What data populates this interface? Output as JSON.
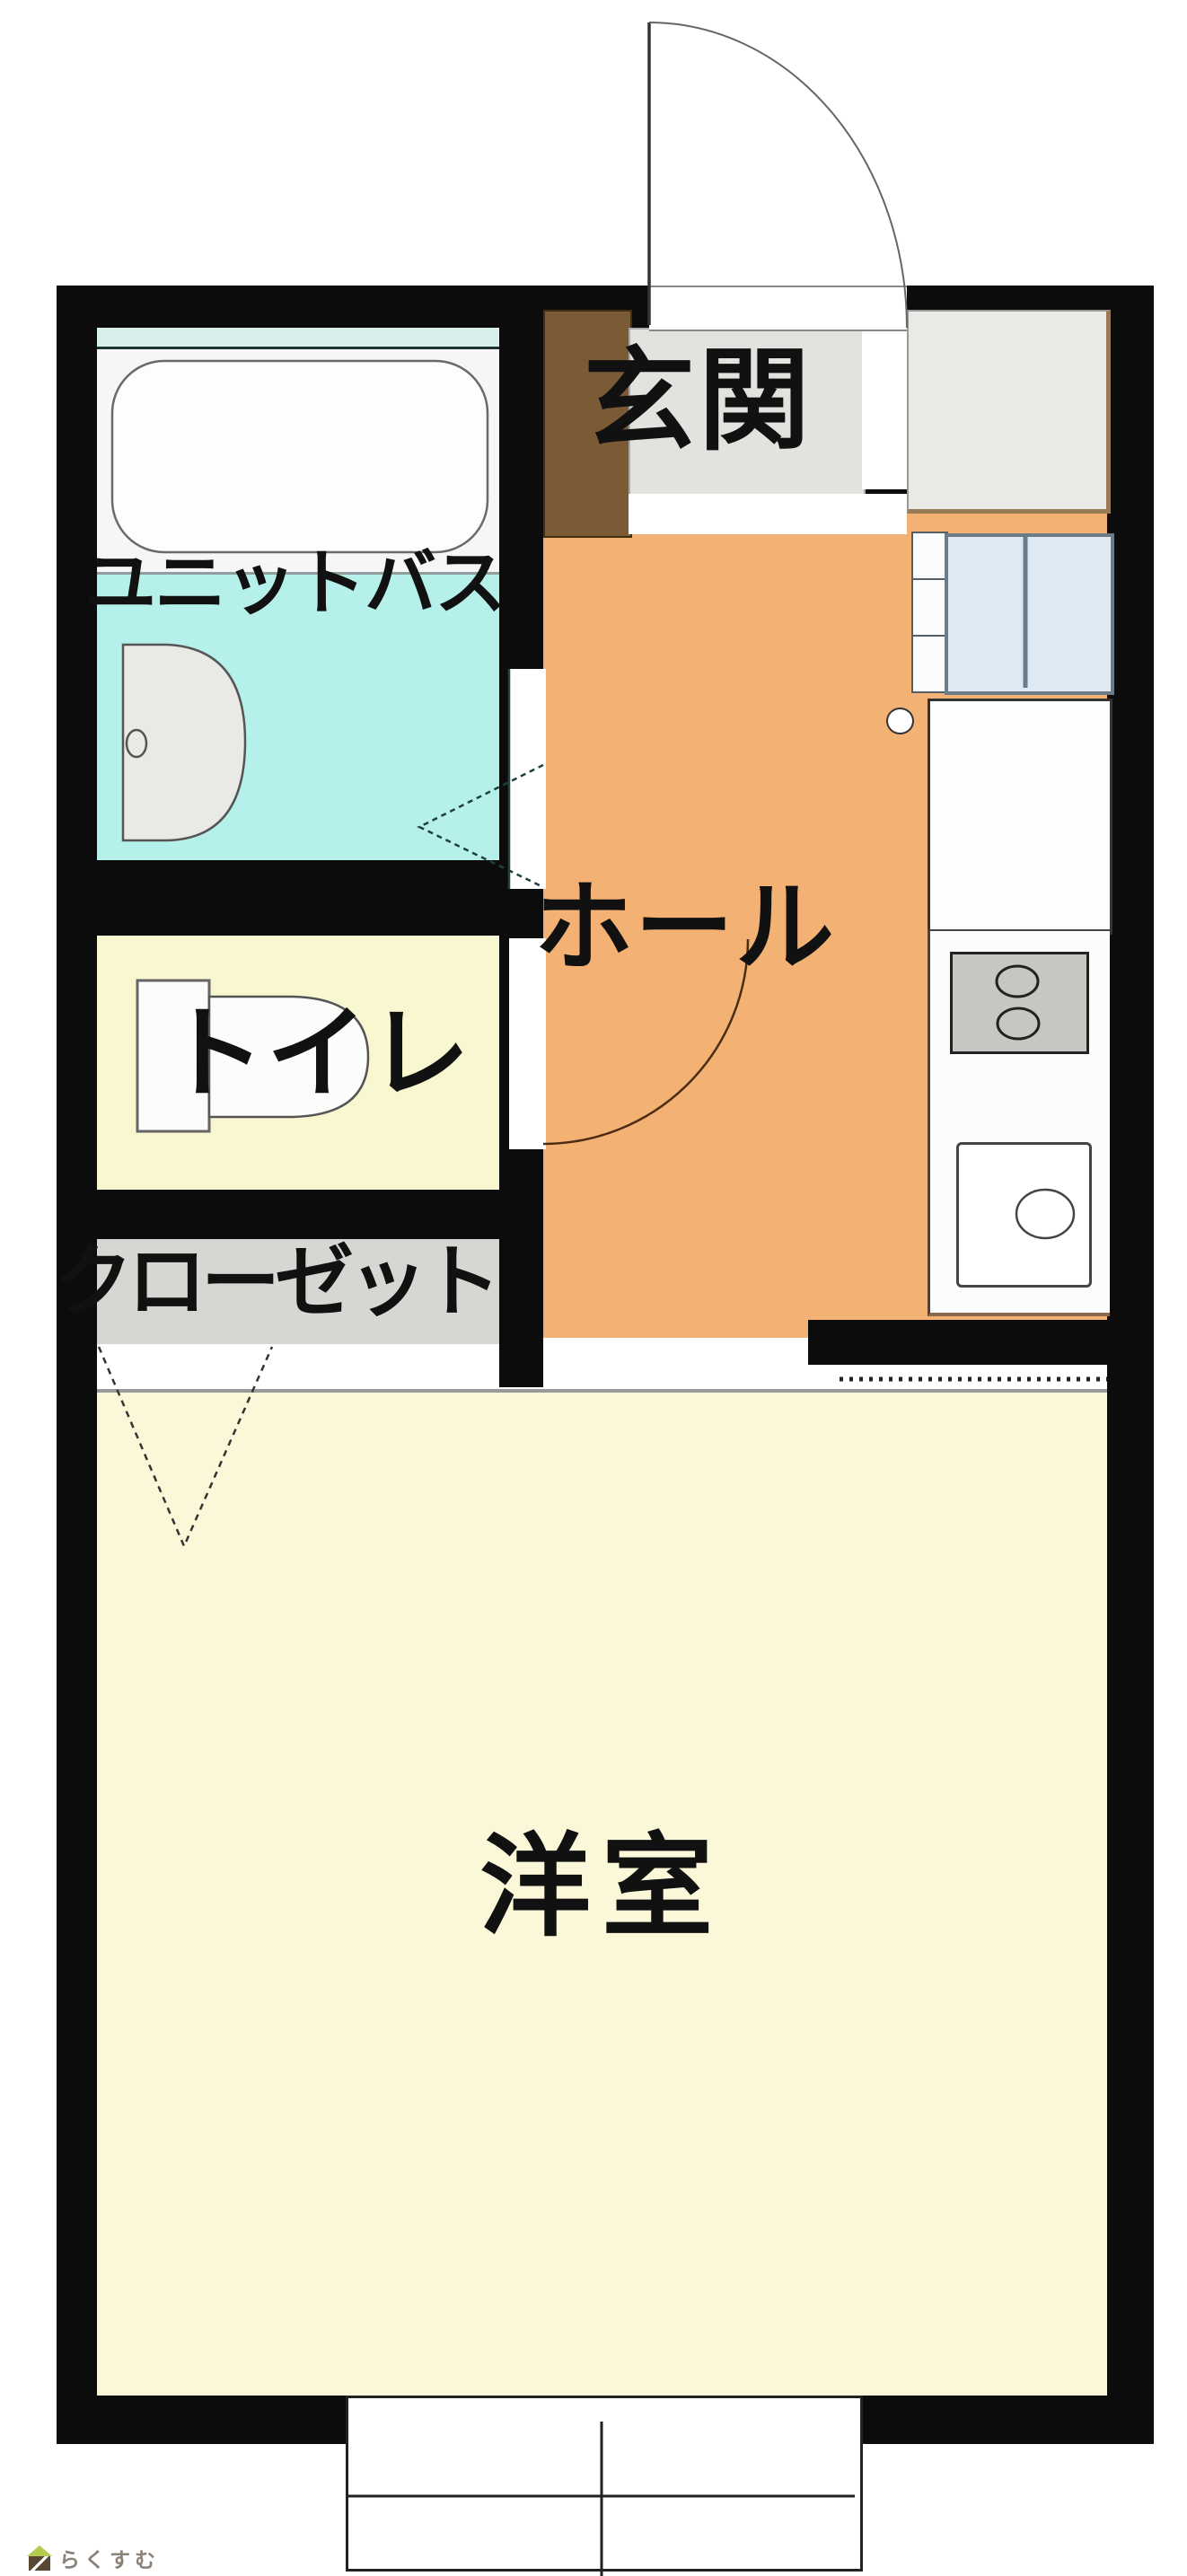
{
  "labels": {
    "unit_bath": "ユニットバス",
    "entrance": "玄関",
    "hall": "ホール",
    "toilet": "トイレ",
    "closet": "クローゼット",
    "western_room": "洋室"
  },
  "watermark": {
    "brand": "らくすむ",
    "icon": "house-icon"
  },
  "colors": {
    "wall_black": "#0c0c0c",
    "hall_orange": "#f3b274",
    "bath_cyan": "#b5f0ea",
    "bath_strip_cyan": "#d9efec",
    "toilet_yellow": "#f9f7cf",
    "room_cream": "#fbf8da",
    "closet_gray": "#d6d6d3",
    "entrance_gray": "#e2e2df",
    "shoe_cabinet_brown": "#7b5b35",
    "window_pane_blue": "#dde9f3",
    "stove_gray": "#c6c6c3",
    "watermark_green": "#b2cc4e",
    "watermark_brown": "#5a4733"
  },
  "fixtures": [
    "bathtub",
    "washbasin",
    "toilet-bowl",
    "entrance-door-swing",
    "toilet-door-swing",
    "bath-folding-door",
    "closet-folding-doors",
    "refrigerator-space",
    "kitchen-window",
    "appliance-space",
    "stove-two-burners",
    "kitchen-sink",
    "balcony-sliding-window"
  ]
}
